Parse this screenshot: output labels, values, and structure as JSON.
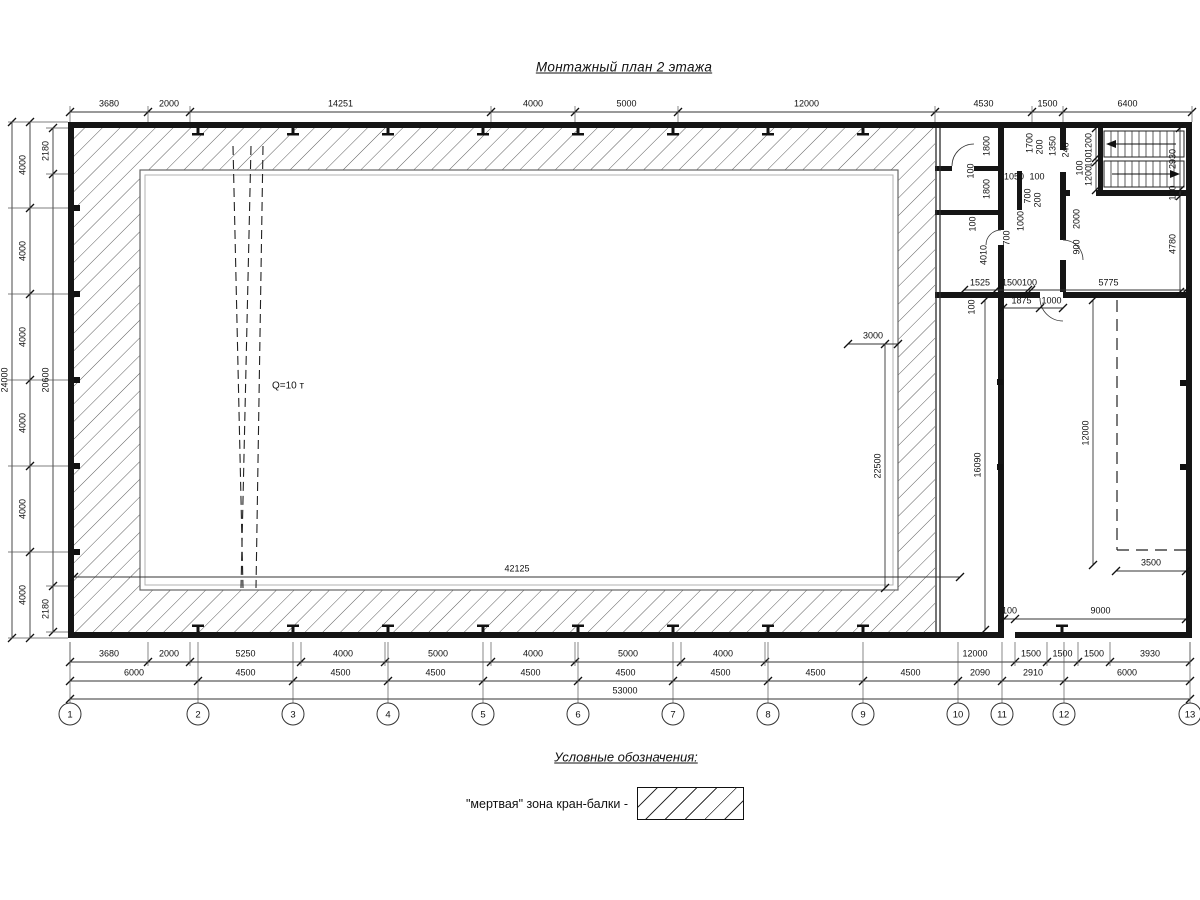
{
  "title": "Монтажный план 2 этажа",
  "legend": {
    "title": "Условные обозначения:",
    "item_label": "\"мертвая\" зона кран-балки -"
  },
  "crane": {
    "capacity_label": "Q=10 т"
  },
  "colors": {
    "line": "#1a1a1a",
    "hatch": "#4a4a4a",
    "window": "#a8a8a8",
    "dim": "#333"
  },
  "axes": {
    "items": [
      {
        "n": "1",
        "x": 70
      },
      {
        "n": "2",
        "x": 198
      },
      {
        "n": "3",
        "x": 293
      },
      {
        "n": "4",
        "x": 388
      },
      {
        "n": "5",
        "x": 483
      },
      {
        "n": "6",
        "x": 578
      },
      {
        "n": "7",
        "x": 673
      },
      {
        "n": "8",
        "x": 768
      },
      {
        "n": "9",
        "x": 863
      },
      {
        "n": "10",
        "x": 958
      },
      {
        "n": "11",
        "x": 1002
      },
      {
        "n": "12",
        "x": 1064
      },
      {
        "n": "13",
        "x": 1190
      }
    ]
  },
  "dims": {
    "top": [
      "3680",
      "2000",
      "14251",
      "4000",
      "5000",
      "12000",
      "4530",
      "1500",
      "6400"
    ],
    "bottom1": [
      "3680",
      "2000",
      "5250",
      "4000",
      "5000",
      "4000",
      "5000",
      "4000",
      "12000",
      "1500",
      "1500",
      "1500",
      "3930"
    ],
    "bottom2": [
      "6000",
      "4500",
      "4500",
      "4500",
      "4500",
      "4500",
      "4500",
      "4500",
      "4500",
      "2090",
      "2910",
      "6000"
    ],
    "bottom3": [
      "53000"
    ],
    "left_inner": [
      "2180",
      "20600",
      "2180"
    ],
    "left_mid": [
      "4000",
      "4000",
      "4000",
      "4000",
      "4000",
      "4000"
    ],
    "left_outer": [
      "24000"
    ],
    "right_side": [
      "2930",
      "100",
      "4780"
    ],
    "stair_side": [
      "1200",
      "100",
      "1200"
    ],
    "annex_row1": [
      "1525",
      "1500",
      "100",
      "5775"
    ],
    "annex_row2": [
      "1875",
      "1000"
    ],
    "v16090": [
      "16090"
    ],
    "v12000": [
      "12000"
    ],
    "h9000": [
      "100",
      "9000"
    ],
    "h3500": [
      "3500"
    ],
    "h42125": [
      "42125"
    ],
    "v22500": [
      "22500"
    ],
    "h3000": [
      "3000"
    ]
  },
  "misc_dims": [
    {
      "t": "1800",
      "x": 987,
      "y": 146,
      "r": 1
    },
    {
      "t": "100",
      "x": 971,
      "y": 171,
      "r": 1
    },
    {
      "t": "1800",
      "x": 987,
      "y": 189,
      "r": 1
    },
    {
      "t": "1050",
      "x": 1014,
      "y": 177,
      "r": 0
    },
    {
      "t": "100",
      "x": 1037,
      "y": 177,
      "r": 0
    },
    {
      "t": "1700",
      "x": 1030,
      "y": 143,
      "r": 1
    },
    {
      "t": "200",
      "x": 1040,
      "y": 147,
      "r": 1
    },
    {
      "t": "1350",
      "x": 1053,
      "y": 146,
      "r": 1
    },
    {
      "t": "246",
      "x": 1066,
      "y": 150,
      "r": 1
    },
    {
      "t": "100",
      "x": 1080,
      "y": 168,
      "r": 1
    },
    {
      "t": "700",
      "x": 1028,
      "y": 196,
      "r": 1
    },
    {
      "t": "200",
      "x": 1038,
      "y": 200,
      "r": 1
    },
    {
      "t": "1000",
      "x": 1021,
      "y": 221,
      "r": 1
    },
    {
      "t": "100",
      "x": 973,
      "y": 224,
      "r": 1
    },
    {
      "t": "4010",
      "x": 984,
      "y": 255,
      "r": 1
    },
    {
      "t": "700",
      "x": 1007,
      "y": 238,
      "r": 1
    },
    {
      "t": "2000",
      "x": 1077,
      "y": 219,
      "r": 1
    },
    {
      "t": "900",
      "x": 1077,
      "y": 247,
      "r": 1
    },
    {
      "t": "100",
      "x": 972,
      "y": 307,
      "r": 1
    }
  ]
}
